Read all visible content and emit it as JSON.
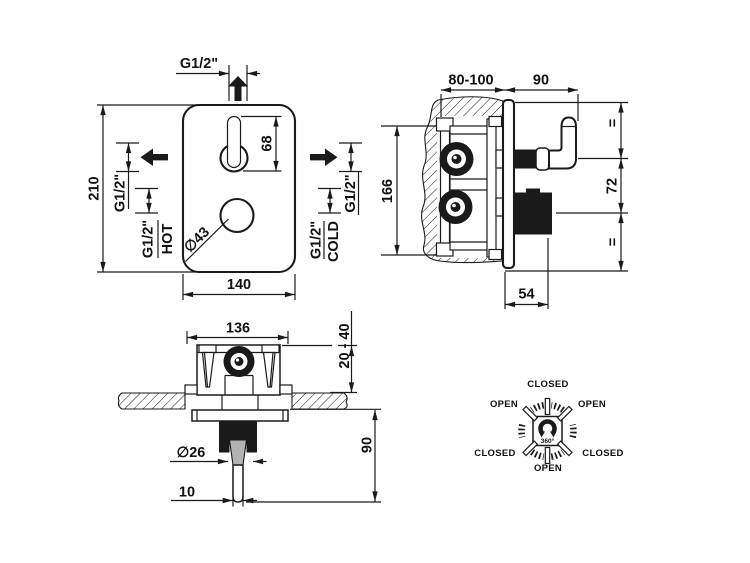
{
  "colors": {
    "line": "#1a1a1a",
    "background": "#ffffff",
    "shading": "#b3b3b3"
  },
  "front_view": {
    "top_connection": "G1/2\"",
    "plate_height": "210",
    "lever_length": "68",
    "plate_width": "140",
    "knob_diameter": "∅43",
    "left_outlet": "G1/2\"",
    "hot_inlet": "G1/2\"",
    "hot_label": "HOT",
    "right_outlet": "G1/2\"",
    "cold_inlet": "G1/2\"",
    "cold_label": "COLD"
  },
  "side_view": {
    "wall_depth": "80-100",
    "handle_projection": "90",
    "body_height": "166",
    "equal_top": "=",
    "handle_knob_distance": "72",
    "equal_bottom": "=",
    "knob_projection": "54"
  },
  "bottom_view": {
    "body_width": "136",
    "plaster_depth_range": "20 - 40",
    "stem_projection": "90",
    "collar_diameter": "∅26",
    "stem_width": "10"
  },
  "rotation_diagram": {
    "top": "CLOSED",
    "upper_left": "OPEN",
    "upper_right": "OPEN",
    "lower_left": "CLOSED",
    "lower_right": "CLOSED",
    "bottom": "OPEN",
    "center": "360°"
  }
}
